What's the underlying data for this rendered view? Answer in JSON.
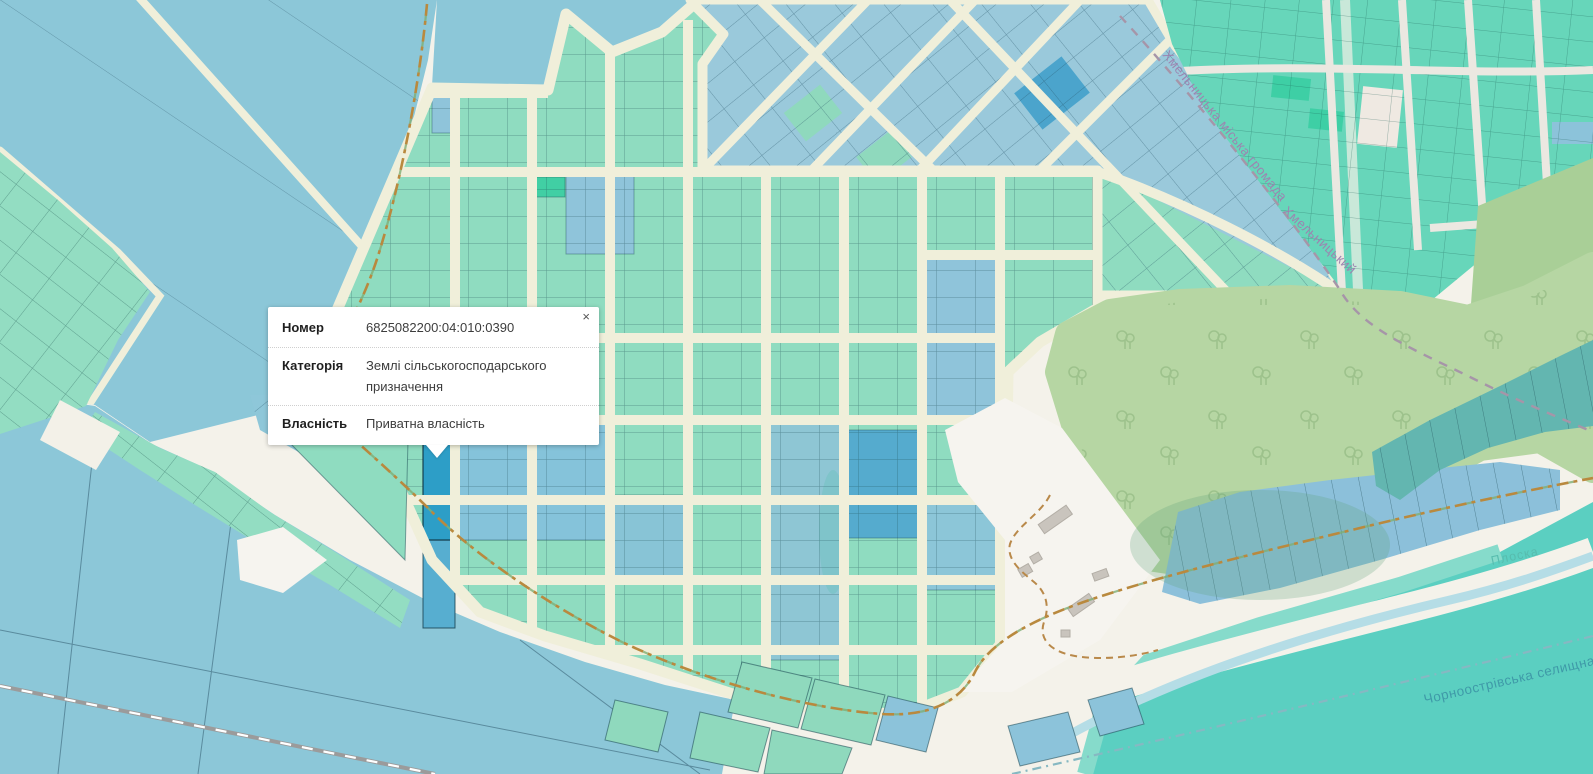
{
  "popup": {
    "close_label": "×",
    "rows": [
      {
        "label": "Номер",
        "value": "6825082200:04:010:0390"
      },
      {
        "label": "Категорія",
        "value": "Землі сільськогосподарського призначення"
      },
      {
        "label": "Власність",
        "value": "Приватна власність"
      }
    ]
  },
  "map_labels": {
    "city_community_boundary": "Хмельницька міська громада",
    "city": "Хмельницький",
    "river": "Плоска",
    "settlement_community_boundary": "Чорноострівська селищна гр"
  },
  "colors": {
    "parcel_green": "#8fdcc0",
    "parcel_green_bright": "#41cfa4",
    "parcel_blue": "#91c5db",
    "parcel_selected": "#2d9ec7",
    "parcel_teal_topright": "#62d5b8",
    "field_blue": "#8cc7d8",
    "water_teal": "#5bcfc1",
    "forest_green": "#b6d6a3",
    "road_cream": "#f0efda",
    "open_land": "#f6f4ef",
    "boundary_orange": "#b9893e",
    "boundary_purple": "#a695a8",
    "label_purple": "#9c84b0",
    "label_teal": "#3f9aa8"
  }
}
